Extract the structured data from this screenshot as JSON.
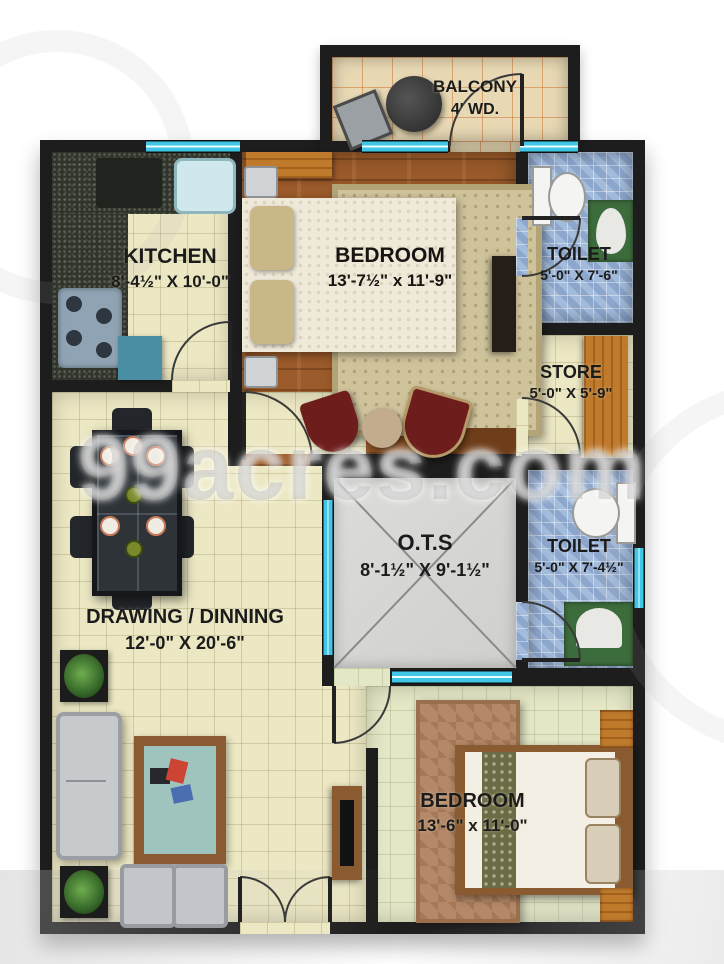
{
  "watermark": "99acres.com",
  "rooms": {
    "balcony": {
      "name": "BALCONY",
      "dims": "4' WD."
    },
    "kitchen": {
      "name": "KITCHEN",
      "dims": "8'-4½\" X 10'-0\""
    },
    "bedroom_top": {
      "name": "BEDROOM",
      "dims": "13'-7½\" x 11'-9\""
    },
    "toilet_top": {
      "name": "TOILET",
      "dims": "5'-0\" X 7'-6\""
    },
    "store": {
      "name": "STORE",
      "dims": "5'-0\" X 5'-9\""
    },
    "ots": {
      "name": "O.T.S",
      "dims": "8'-1½\" X 9'-1½\""
    },
    "toilet_mid": {
      "name": "TOILET",
      "dims": "5'-0\" X 7'-4½\""
    },
    "drawing": {
      "name": "DRAWING / DINNING",
      "dims": "12'-0\" X 20'-6\""
    },
    "bedroom_bottom": {
      "name": "BEDROOM",
      "dims": "13'-6\" x 11'-0\""
    }
  },
  "colors": {
    "wall": "#1d1d1d",
    "window_accent": "#3fc6e6",
    "wood_floor": "#9a5a2a",
    "cream_tile": "#ece8c4",
    "blue_tile": "#a4bcdc",
    "ots_gray": "#d6d6d4",
    "basin_green": "#3c6b3c"
  }
}
